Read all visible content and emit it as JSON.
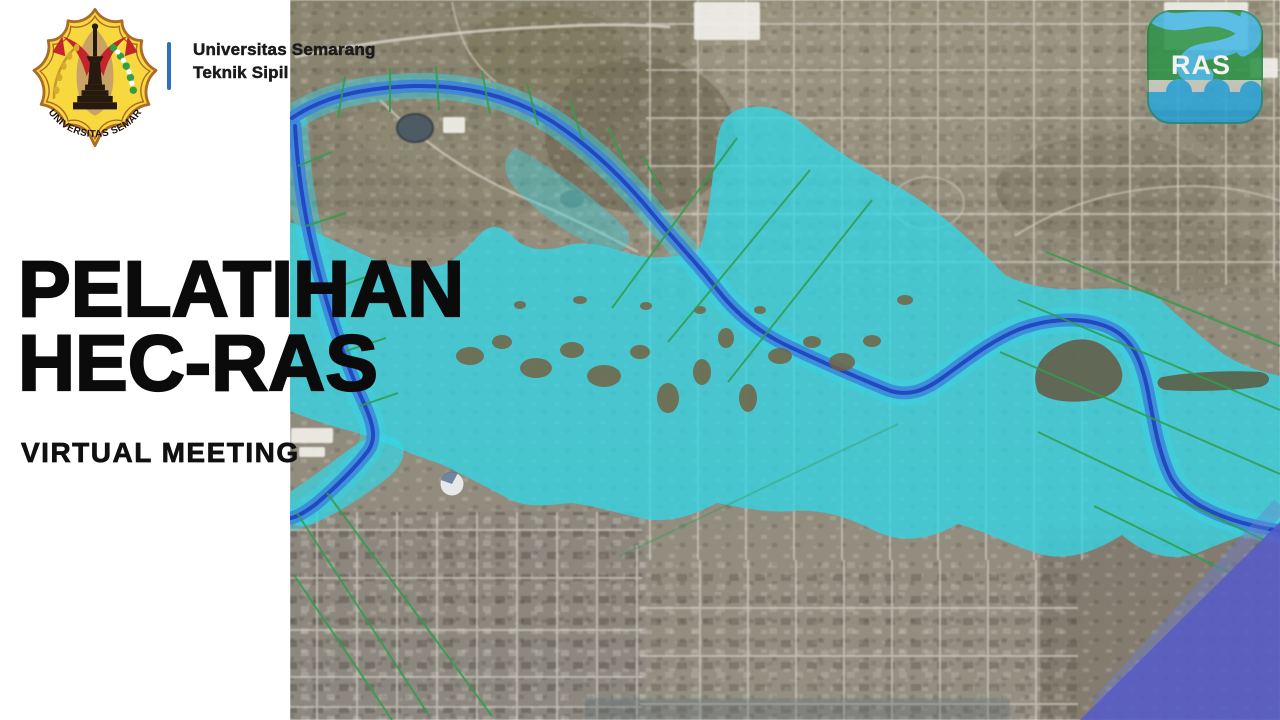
{
  "header": {
    "university": "Universitas Semarang",
    "department": "Teknik Sipil",
    "logo_motto": "UNIVERSITAS SEMARANG"
  },
  "hero": {
    "title_line1": "PELATIHAN",
    "title_line2": "HEC-RAS",
    "subtitle": "VIRTUAL MEETING"
  },
  "hecras_badge": {
    "label": "RAS"
  },
  "map_colors": {
    "flood_cyan": "#33D6E6",
    "river_band": "#3C85DC",
    "river_channel": "#2244C0",
    "cross_section_green": "#2F9E4C",
    "deep_flood_purple": "#575BC8",
    "terrain_base": "#98927F",
    "divider_blue": "#2F6FC1"
  }
}
